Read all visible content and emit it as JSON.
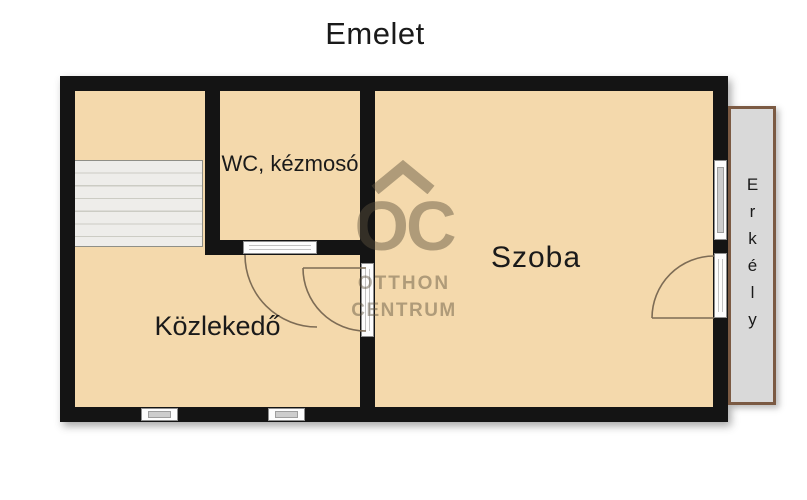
{
  "title": "Emelet",
  "rooms": {
    "wc": {
      "label": "WC, kézmosó"
    },
    "szoba": {
      "label": "Szoba"
    },
    "kozlekedo": {
      "label": "Közlekedő"
    },
    "erkely": {
      "label": "Erkély"
    }
  },
  "watermark": {
    "logo": "OC",
    "line1": "OTTHON",
    "line2": "CENTRUM"
  },
  "colors": {
    "room_fill": "#f4d9ac",
    "wall": "#141414",
    "balcony_fill": "#d9d9d9",
    "balcony_border": "#7b5a43",
    "stairs_fill": "#eeedea",
    "stairs_line": "#ccccc4",
    "door_arc": "#7d6c55",
    "watermark": "rgba(90,80,60,0.45)",
    "label_text": "#1a1a1a"
  }
}
